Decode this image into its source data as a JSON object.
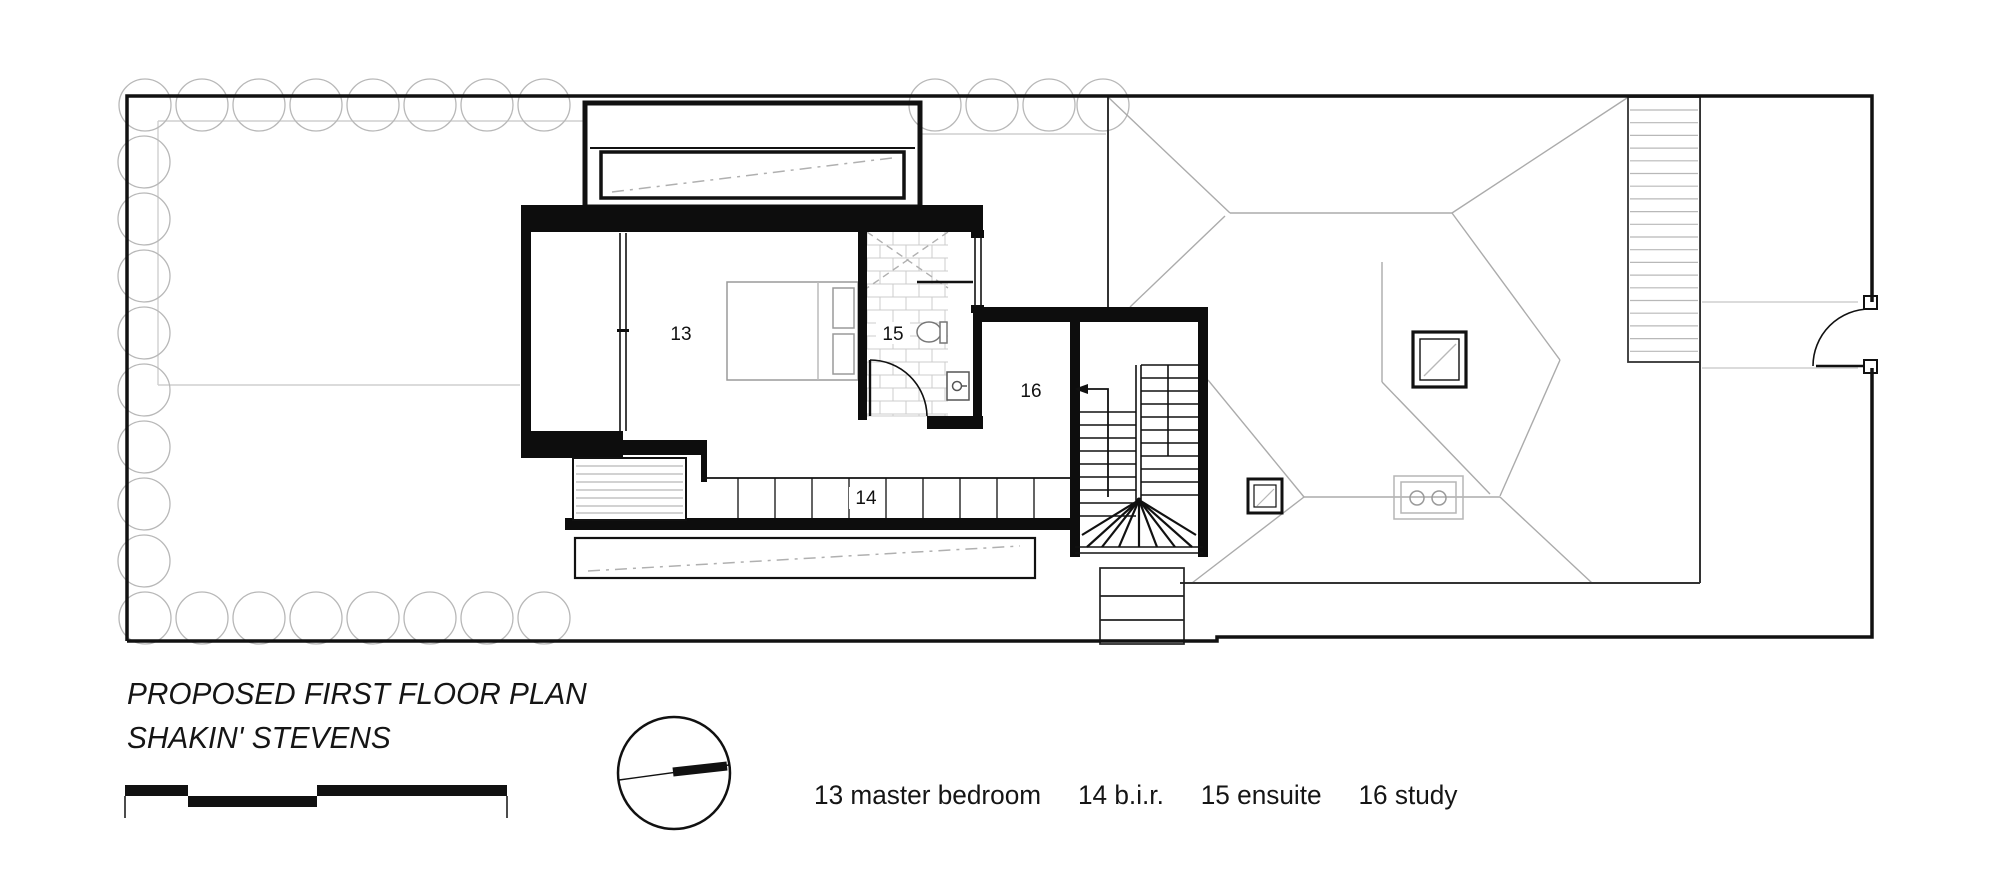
{
  "drawing": {
    "title_line1": "PROPOSED FIRST FLOOR PLAN",
    "title_line2": "SHAKIN' STEVENS",
    "legend_items": [
      "13 master bedroom",
      "14 b.i.r.",
      "15 ensuite",
      "16 study"
    ],
    "room_labels": {
      "master_bedroom": "13",
      "built_in_robe": "14",
      "ensuite": "15",
      "study": "16"
    },
    "colors": {
      "wall": "#0d0d0d",
      "line_black": "#111111",
      "line_dark": "#333333",
      "line_gray": "#ababab",
      "line_light_gray": "#cfcfcf",
      "tree_gray": "#b8b8b8"
    }
  }
}
